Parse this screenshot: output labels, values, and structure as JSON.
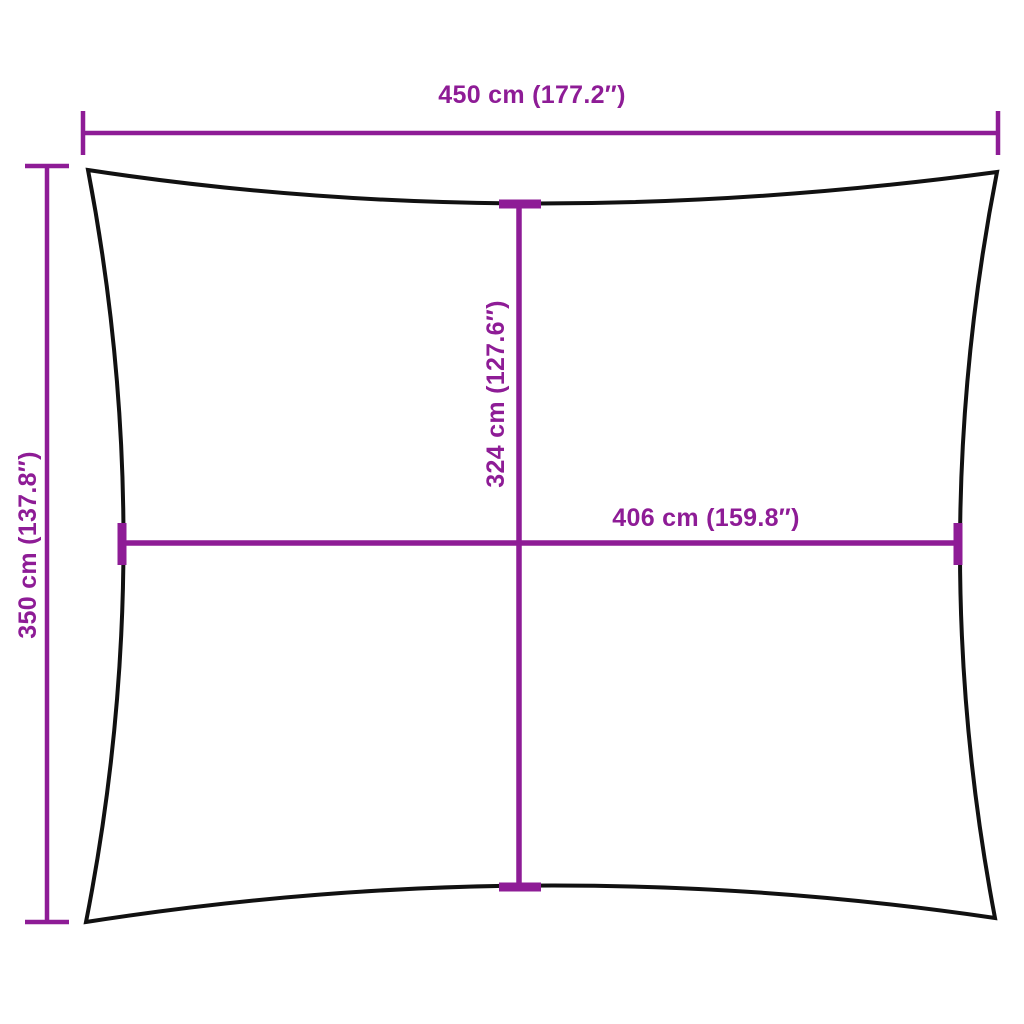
{
  "diagram": {
    "kind": "shade-sail-dimension-diagram",
    "background_color": "#ffffff",
    "outline_color": "#111111",
    "dimension_color": "#8e1c96",
    "labels": {
      "top_width": "450 cm (177.2″)",
      "left_height": "350 cm (137.8″)",
      "inner_height": "324 cm (127.6″)",
      "inner_width": "406 cm (159.8″)"
    }
  }
}
